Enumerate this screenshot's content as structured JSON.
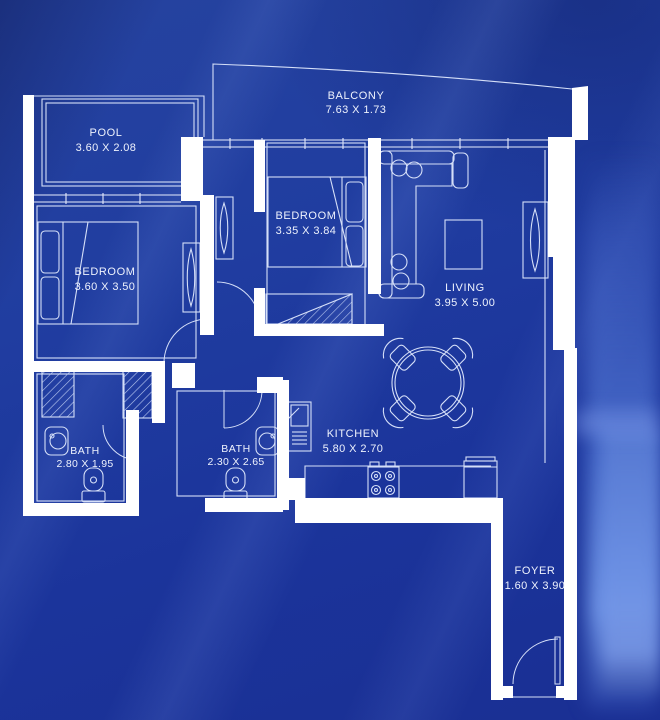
{
  "title": "Apartment Floor Plan Blueprint",
  "colors": {
    "background": "#1e3a9e",
    "walls": "#ffffff",
    "lines": "#d5dff8",
    "windows": "#e6ecfd",
    "text": "#eef2fd"
  },
  "rooms": {
    "balcony": {
      "name": "BALCONY",
      "dims": "7.63 X 1.73"
    },
    "pool": {
      "name": "POOL",
      "dims": "3.60 X 2.08"
    },
    "bedroom_top": {
      "name": "BEDROOM",
      "dims": "3.35 X 3.84"
    },
    "bedroom_left": {
      "name": "BEDROOM",
      "dims": "3.60 X 3.50"
    },
    "living": {
      "name": "LIVING",
      "dims": "3.95 X 5.00"
    },
    "bath_left": {
      "name": "BATH",
      "dims": "2.80 X 1.95"
    },
    "bath_middle": {
      "name": "BATH",
      "dims": "2.30 X 2.65"
    },
    "kitchen": {
      "name": "KITCHEN",
      "dims": "5.80 X 2.70"
    },
    "foyer": {
      "name": "FOYER",
      "dims": "1.60 X 3.90"
    }
  }
}
